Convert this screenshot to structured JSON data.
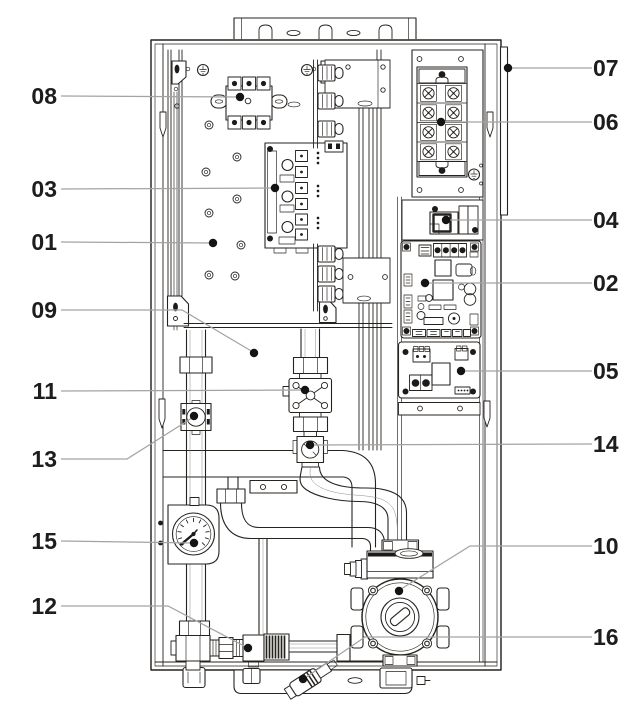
{
  "figure": {
    "type": "technical-parts-diagram",
    "subject": "wall-hung electric boiler, front view with casing removed, numbered component callouts",
    "canvas": {
      "width": 634,
      "height": 709
    },
    "colors": {
      "background": "#ffffff",
      "outline": "#26231f",
      "leader_line": "#a3a3a3",
      "callout_dot": "#141414",
      "label_text": "#1d1d1f"
    },
    "callouts": [
      {
        "label": "08",
        "side": "left",
        "text": [
          57,
          104
        ],
        "leader": [
          [
            61,
            96
          ],
          [
            240,
            97
          ]
        ],
        "dot": [
          240,
          97
        ]
      },
      {
        "label": "03",
        "side": "left",
        "text": [
          57,
          197
        ],
        "leader": [
          [
            61,
            189
          ],
          [
            275,
            188
          ]
        ],
        "dot": [
          275,
          188
        ]
      },
      {
        "label": "01",
        "side": "left",
        "text": [
          57,
          250
        ],
        "leader": [
          [
            61,
            242
          ],
          [
            213,
            243
          ]
        ],
        "dot": [
          213,
          243
        ]
      },
      {
        "label": "09",
        "side": "left",
        "text": [
          57,
          318
        ],
        "leader": [
          [
            61,
            310
          ],
          [
            182,
            310
          ],
          [
            253,
            352
          ]
        ],
        "dot": [
          254,
          353
        ]
      },
      {
        "label": "11",
        "side": "left",
        "text": [
          57,
          399
        ],
        "leader": [
          [
            61,
            391
          ],
          [
            305,
            390
          ]
        ],
        "dot": [
          305,
          390
        ]
      },
      {
        "label": "13",
        "side": "left",
        "text": [
          57,
          467
        ],
        "leader": [
          [
            61,
            459
          ],
          [
            127,
            459
          ],
          [
            192,
            418
          ]
        ],
        "dot": [
          194,
          416
        ]
      },
      {
        "label": "15",
        "side": "left",
        "text": [
          57,
          549
        ],
        "leader": [
          [
            61,
            541
          ],
          [
            194,
            543
          ]
        ],
        "dot": [
          194,
          543
        ]
      },
      {
        "label": "12",
        "side": "left",
        "text": [
          57,
          614
        ],
        "leader": [
          [
            61,
            606
          ],
          [
            168,
            606
          ],
          [
            246,
            647
          ]
        ],
        "dot": [
          248,
          648
        ]
      },
      {
        "label": "07",
        "side": "right",
        "text": [
          593,
          76
        ],
        "leader": [
          [
            592,
            68
          ],
          [
            508,
            68
          ]
        ],
        "dot": [
          508,
          68
        ]
      },
      {
        "label": "06",
        "side": "right",
        "text": [
          593,
          130
        ],
        "leader": [
          [
            592,
            122
          ],
          [
            441,
            122
          ]
        ],
        "dot": [
          441,
          122
        ]
      },
      {
        "label": "04",
        "side": "right",
        "text": [
          593,
          228
        ],
        "leader": [
          [
            592,
            220
          ],
          [
            446,
            220
          ]
        ],
        "dot": [
          446,
          220
        ]
      },
      {
        "label": "02",
        "side": "right",
        "text": [
          593,
          291
        ],
        "leader": [
          [
            592,
            283
          ],
          [
            425,
            283
          ]
        ],
        "dot": [
          425,
          283
        ]
      },
      {
        "label": "05",
        "side": "right",
        "text": [
          593,
          379
        ],
        "leader": [
          [
            592,
            371
          ],
          [
            461,
            371
          ]
        ],
        "dot": [
          461,
          371
        ]
      },
      {
        "label": "14",
        "side": "right",
        "text": [
          593,
          452
        ],
        "leader": [
          [
            592,
            444
          ],
          [
            313,
            445
          ]
        ],
        "dot": [
          310,
          445
        ]
      },
      {
        "label": "10",
        "side": "right",
        "text": [
          593,
          554
        ],
        "leader": [
          [
            592,
            546
          ],
          [
            470,
            546
          ],
          [
            401,
            589
          ]
        ],
        "dot": [
          399,
          591
        ]
      },
      {
        "label": "16",
        "side": "right",
        "text": [
          593,
          645
        ],
        "leader": [
          [
            592,
            637
          ],
          [
            365,
            637
          ],
          [
            305,
            678
          ]
        ],
        "dot": [
          303,
          679
        ]
      }
    ]
  }
}
